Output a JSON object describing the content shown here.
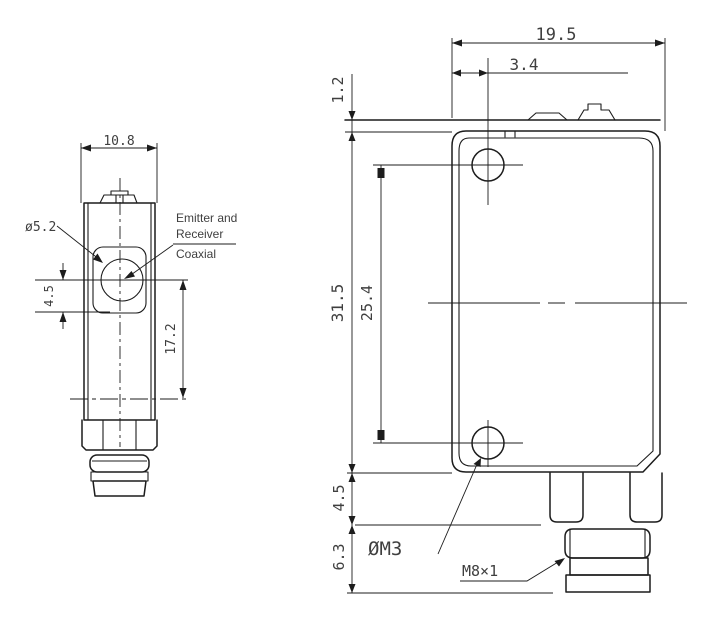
{
  "views": {
    "front": {
      "dims": {
        "width": "10.8",
        "lens": "ø5.2",
        "lens_offset": "4.5",
        "center_height": "17.2"
      },
      "annotation": [
        "Emitter and",
        "Receiver",
        "Coaxial"
      ]
    },
    "side": {
      "dims": {
        "width": "19.5",
        "hole_offset": "3.4",
        "cover": "1.2",
        "height": "31.5",
        "hole_spacing": "25.4",
        "step": "4.5",
        "connector": "6.3"
      },
      "labels": {
        "mounting_hole": "ØM3",
        "thread": "M8×1"
      }
    }
  },
  "colors": {
    "line": "#1c1c1c",
    "dim_text": "#3f3f3f",
    "background": "#ffffff"
  }
}
